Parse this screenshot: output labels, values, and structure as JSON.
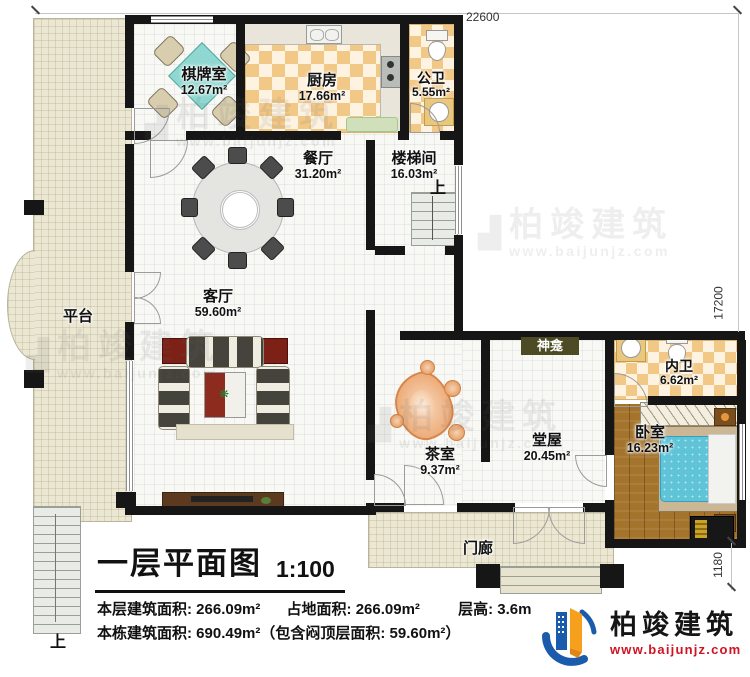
{
  "plan": {
    "rooms": [
      {
        "name": "棋牌室",
        "area": "12.67m²"
      },
      {
        "name": "厨房",
        "area": "17.66m²"
      },
      {
        "name": "公卫",
        "area": "5.55m²"
      },
      {
        "name": "餐厅",
        "area": "31.20m²"
      },
      {
        "name": "楼梯间",
        "area": "16.03m²"
      },
      {
        "name": "客厅",
        "area": "59.60m²"
      },
      {
        "name": "茶室",
        "area": "9.37m²"
      },
      {
        "name": "堂屋",
        "area": "20.45m²"
      },
      {
        "name": "内卫",
        "area": "6.62m²"
      },
      {
        "name": "卧室",
        "area": "16.23m²"
      }
    ],
    "platform_label": "平台",
    "shrine_label": "神龛",
    "porch_label": "门廊",
    "stairs_up_label": "上",
    "exterior_stairs_up_label": "上"
  },
  "dimensions": {
    "top": "22600",
    "right": "17200",
    "right_lower": "1180"
  },
  "title_block": {
    "title": "一层平面图",
    "scale": "1:100",
    "line1": [
      "本层建筑面积: 266.09m²",
      "占地面积: 266.09m²",
      "层高: 3.6m"
    ],
    "line2": "本栋建筑面积: 690.49m²（包含闷顶层面积: 59.60m²）"
  },
  "logo": {
    "company": "柏竣建筑",
    "website": "www.baijunjz.com"
  },
  "watermark": {
    "company": "柏竣建筑",
    "website": "www.baijunjz.com"
  },
  "colors": {
    "wall": "#161616",
    "checker_tan": "#f2c887",
    "platform_beige": "#ebe7d3",
    "bedroom_wood": "#a4732c",
    "bed_cyan": "#5fc4d8",
    "logo_blue": "#1b5bab",
    "logo_orange": "#f6a01d",
    "url_red": "#cf1322"
  }
}
